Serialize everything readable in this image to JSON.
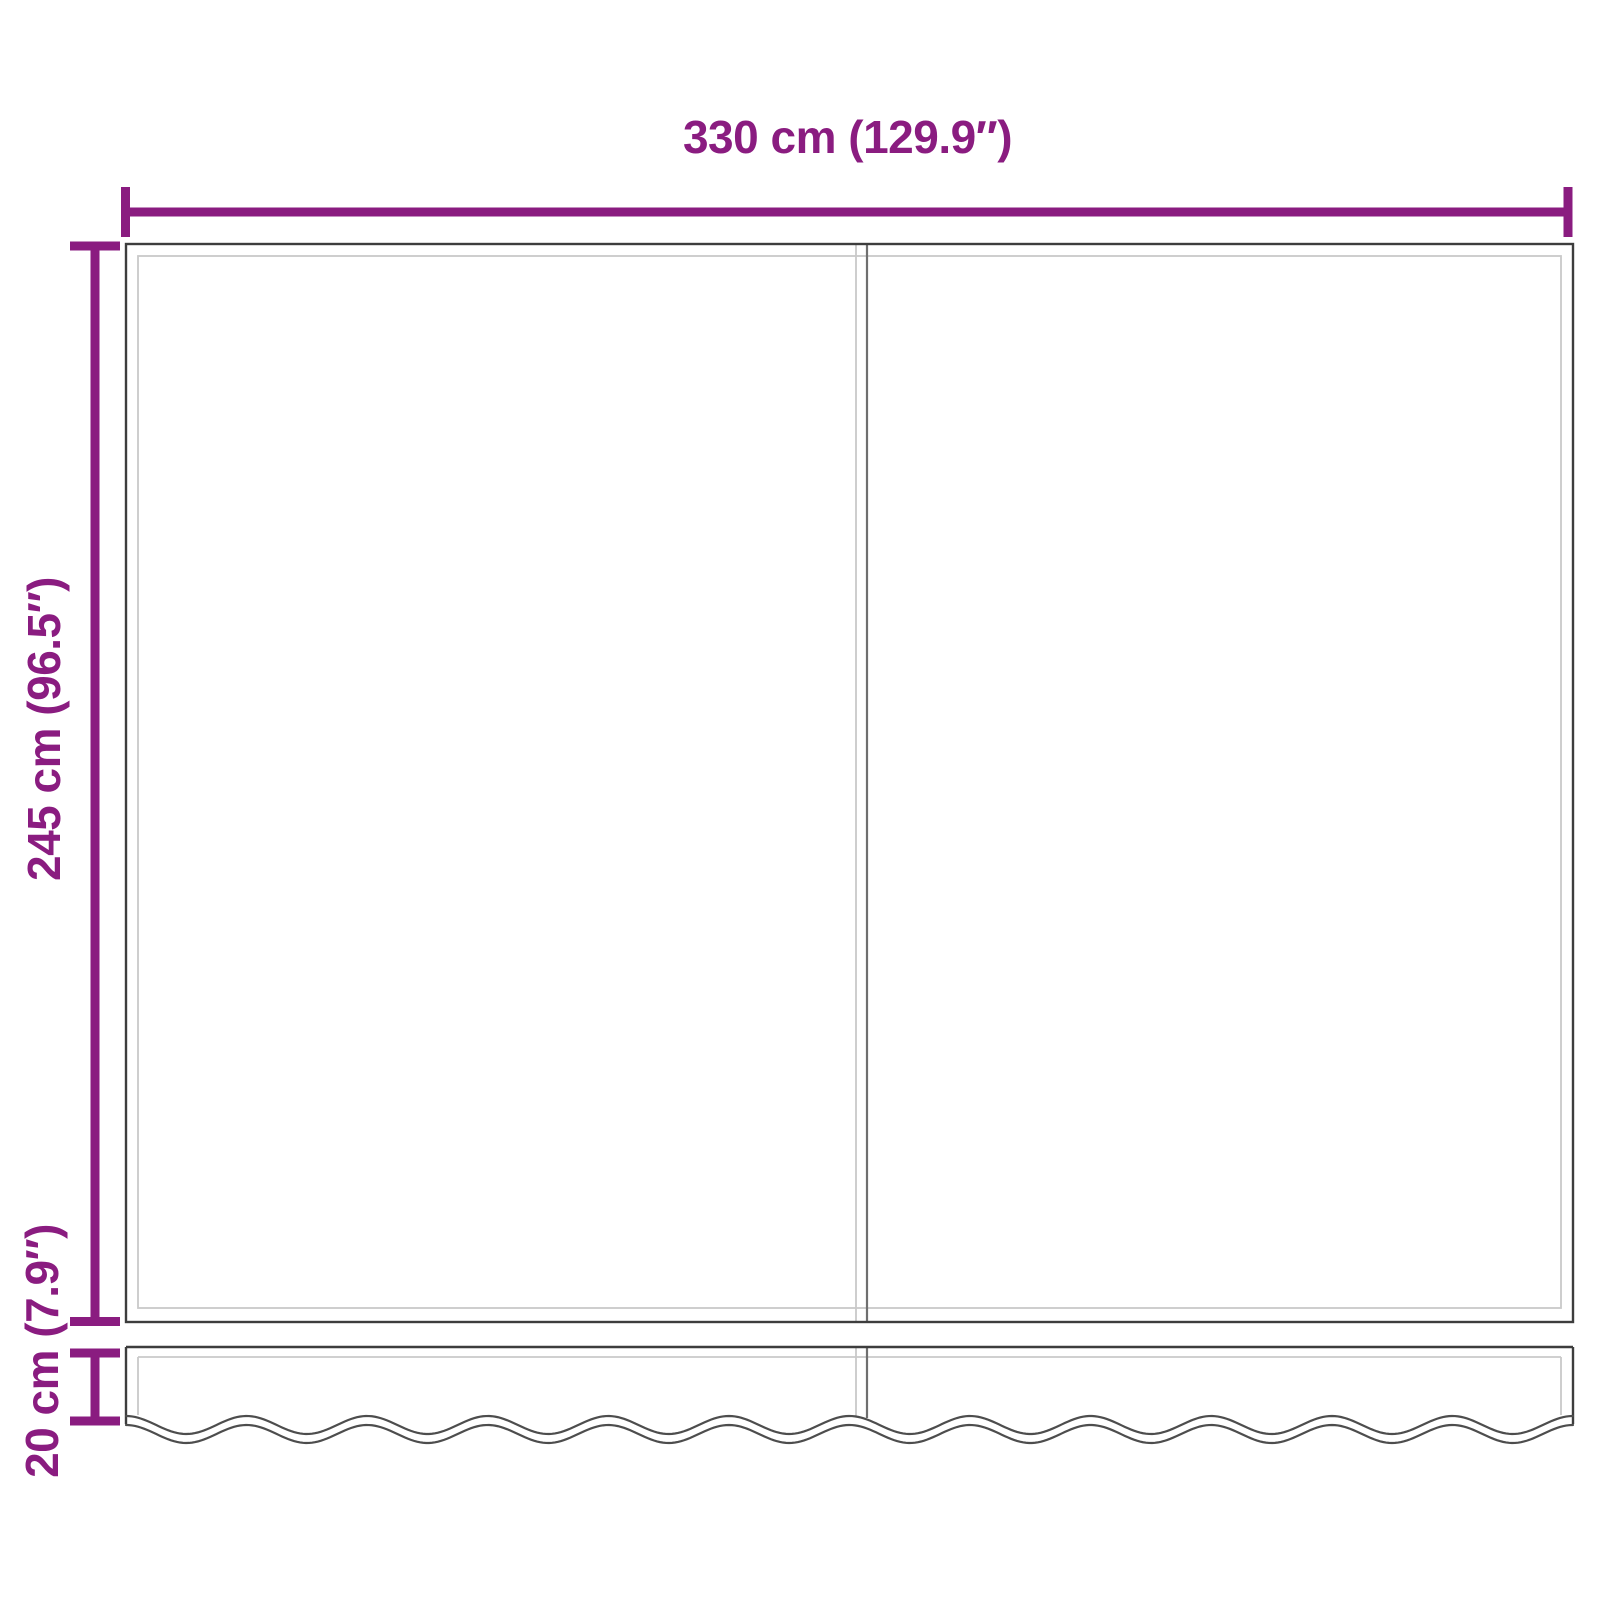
{
  "dimensions": {
    "width": {
      "label": "330 cm (129.9″)",
      "value_cm": 330,
      "value_in": 129.9
    },
    "height": {
      "label": "245 cm (96.5″)",
      "value_cm": 245,
      "value_in": 96.5
    },
    "valance": {
      "label": "20 cm (7.9″)",
      "value_cm": 20,
      "value_in": 7.9
    }
  },
  "colors": {
    "accent": "#8A1C80",
    "outline": "#3D3D3D",
    "seam": "#6F6F6F",
    "inner_line": "#C9C9C9",
    "background": "#FFFFFF"
  }
}
